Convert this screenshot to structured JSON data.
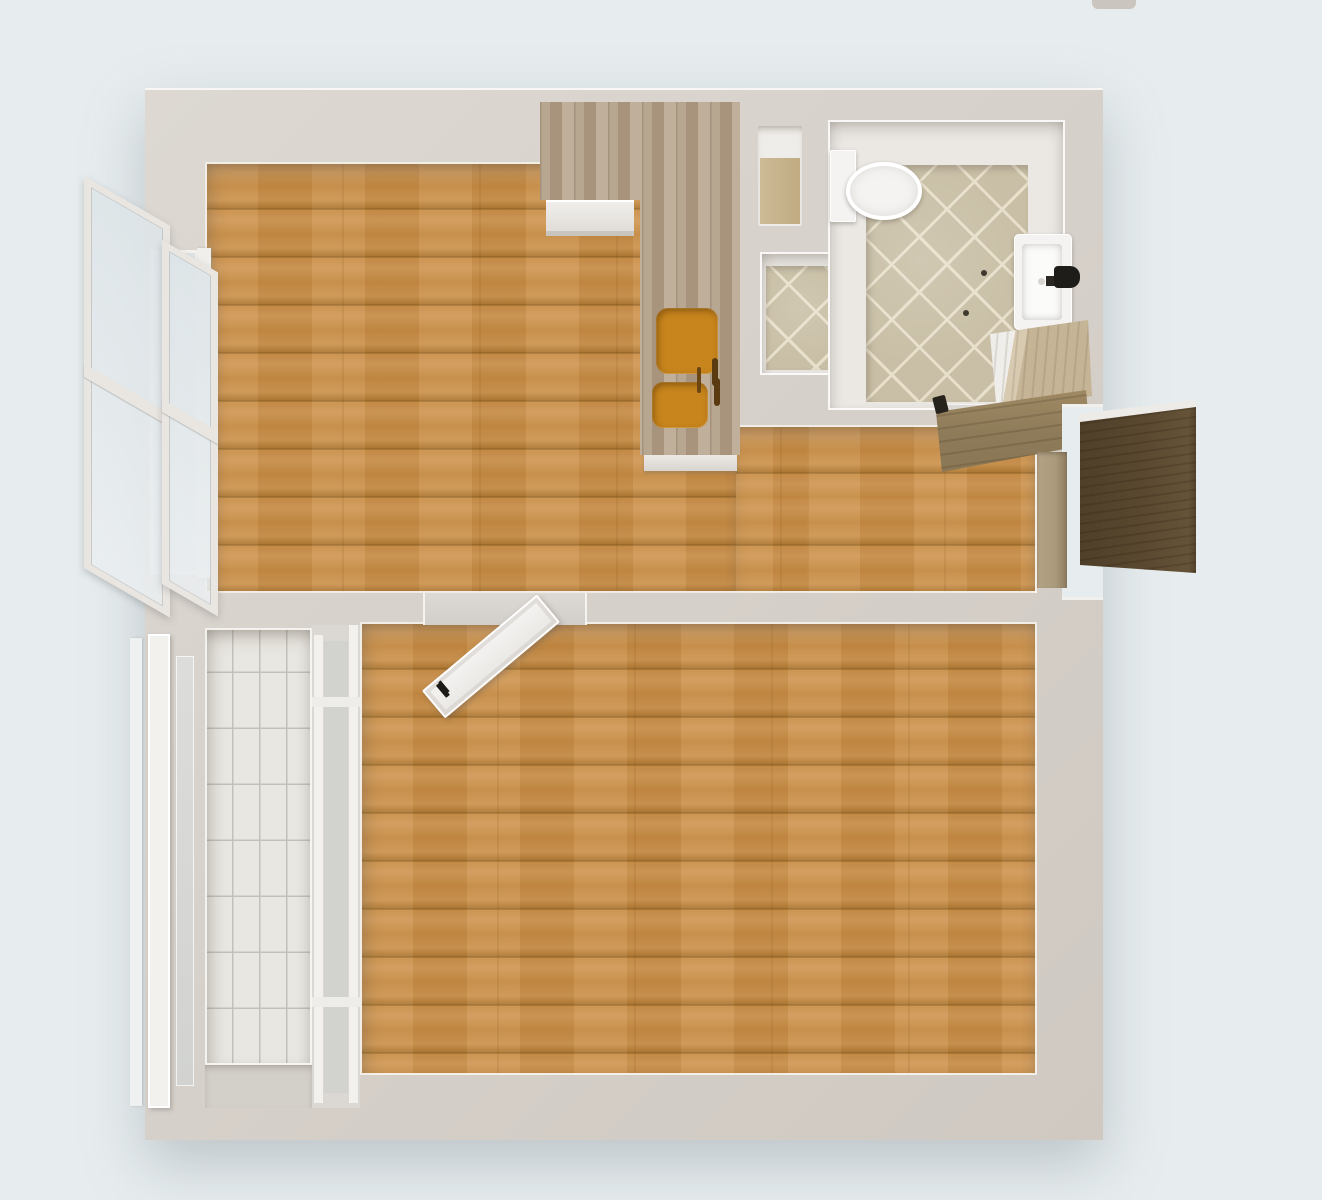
{
  "scene": {
    "type": "3d-floor-plan-top-down",
    "description": "One-bedroom apartment 3D floor plan viewed from above, no text labels",
    "background_color": "#e7edef"
  },
  "palette": {
    "bg": "#e7edef",
    "wall": "#d7d1cb",
    "trim": "#f6f5f3",
    "wood": "#c8914c",
    "wood_dark": "#8f6224",
    "counter": "#b3a18a",
    "sink": "#c8851d",
    "tile": "#c9bfa6",
    "grout": "#e8e0cb",
    "btile": "#e9e7e2",
    "bgrout": "#c3c0ba",
    "taupe_door": "#93836a",
    "wood_door": "#8d7a58",
    "white_fix": "#f4f3f1",
    "glass": "#dfe5e8",
    "tan_floor": "#cdbb96",
    "threshold": "#ab9a7c",
    "balcony_gray": "#d3cfc9"
  },
  "rooms": [
    {
      "id": "living-room",
      "floor": "wood-planks",
      "position": "top-left"
    },
    {
      "id": "kitchen",
      "floor": "wood-planks",
      "position": "top-center",
      "features": [
        "l-shaped-counter",
        "double-bowl-amber-sink",
        "stove-front"
      ]
    },
    {
      "id": "hallway",
      "floor": "wood-planks",
      "position": "center-right"
    },
    {
      "id": "bathroom",
      "floor": "beige-diagonal-tile",
      "position": "top-right",
      "features": [
        "toilet",
        "wall-sink",
        "vanity-cabinet",
        "open-wood-door"
      ]
    },
    {
      "id": "closet-niche",
      "floor": "tan-wood",
      "position": "top-center-right"
    },
    {
      "id": "storage-niche",
      "floor": "beige-diagonal-tile",
      "position": "center-top-right"
    },
    {
      "id": "bedroom",
      "floor": "wood-planks",
      "position": "bottom"
    },
    {
      "id": "balcony",
      "floor": "white-subway-tile",
      "position": "bottom-left"
    }
  ],
  "fixtures": [
    {
      "id": "kitchen-counter",
      "material": "weathered-wood",
      "shape": "L"
    },
    {
      "id": "kitchen-sink",
      "color": "#c8851d",
      "bowls": 2
    },
    {
      "id": "toilet",
      "color": "#f4f3f1"
    },
    {
      "id": "bathroom-sink",
      "color": "#f4f3f1",
      "faucet": "black"
    },
    {
      "id": "vanity-cabinet",
      "color": "#c6b496"
    },
    {
      "id": "bathroom-door",
      "state": "open",
      "material": "dark-wood"
    },
    {
      "id": "entry-door",
      "state": "open-outward",
      "material": "taupe-wood",
      "position": "right-wall"
    },
    {
      "id": "interior-door",
      "state": "open",
      "color": "white",
      "between": [
        "living-room",
        "bedroom"
      ]
    },
    {
      "id": "left-window",
      "state": "open-outward",
      "sashes": 2
    },
    {
      "id": "balcony-glazing",
      "state": "closed",
      "frames": "white"
    }
  ]
}
